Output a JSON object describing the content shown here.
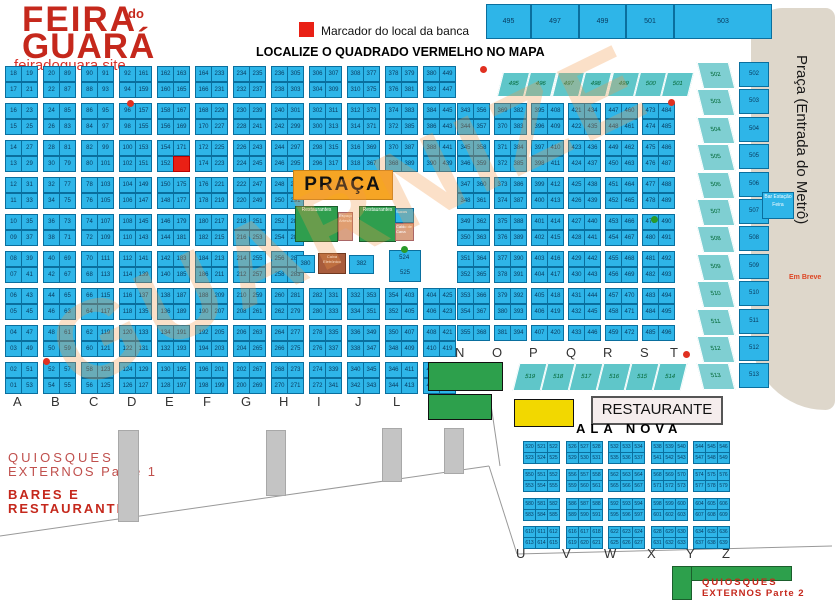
{
  "header": {
    "logo_top": "FEIRA",
    "logo_mid": "do",
    "logo_bottom": "GUARÁ",
    "site": "feiradoguara.site"
  },
  "legend": {
    "marker_label": "Marcador do local da banca",
    "locate": "LOCALIZE O QUADRADO VERMELHO NO MAPA"
  },
  "top_strip": [
    "495",
    "497",
    "499",
    "501",
    "503"
  ],
  "watermark": "GUARNIZE",
  "marker_stall": "173",
  "left_grid": {
    "letters": [
      "A",
      "B",
      "C",
      "D",
      "E",
      "F",
      "G",
      "H",
      "I",
      "J",
      "L",
      "M"
    ],
    "columns": [
      {
        "letter": "A",
        "left": [
          "18",
          "17",
          "16",
          "15",
          "14",
          "13",
          "12",
          "11",
          "10",
          "09",
          "08",
          "07",
          "06",
          "05",
          "04",
          "03",
          "02",
          "01"
        ],
        "right": [
          19,
          21,
          23,
          25,
          27,
          29,
          31,
          33,
          35,
          37,
          39,
          41,
          43,
          45,
          47,
          49,
          51,
          53
        ]
      },
      {
        "letter": "B",
        "left": [
          20,
          22,
          24,
          26,
          28,
          30,
          32,
          34,
          36,
          38,
          40,
          42,
          44,
          46,
          48,
          50,
          52,
          54
        ],
        "right": [
          89,
          87,
          85,
          83,
          81,
          79,
          77,
          75,
          73,
          71,
          69,
          67,
          65,
          63,
          61,
          59,
          57,
          55
        ]
      },
      {
        "letter": "C",
        "left": [
          90,
          88,
          86,
          84,
          82,
          80,
          78,
          76,
          74,
          72,
          70,
          68,
          66,
          64,
          62,
          60,
          58,
          56
        ],
        "right": [
          91,
          93,
          95,
          97,
          99,
          101,
          103,
          105,
          107,
          109,
          111,
          113,
          115,
          117,
          119,
          121,
          123,
          125
        ]
      },
      {
        "letter": "D",
        "left": [
          92,
          94,
          96,
          98,
          100,
          102,
          104,
          106,
          108,
          110,
          112,
          114,
          116,
          118,
          120,
          122,
          124,
          126
        ],
        "right": [
          161,
          159,
          157,
          155,
          153,
          151,
          149,
          147,
          145,
          143,
          141,
          139,
          137,
          135,
          133,
          131,
          129,
          127
        ]
      },
      {
        "letter": "E",
        "left": [
          162,
          160,
          158,
          156,
          154,
          152,
          150,
          148,
          146,
          144,
          142,
          140,
          138,
          136,
          134,
          132,
          130,
          128
        ],
        "right": [
          163,
          165,
          167,
          169,
          171,
          173,
          175,
          177,
          179,
          181,
          183,
          185,
          187,
          189,
          191,
          193,
          195,
          197
        ]
      },
      {
        "letter": "F",
        "left": [
          164,
          166,
          168,
          170,
          172,
          174,
          176,
          178,
          180,
          182,
          184,
          186,
          188,
          190,
          192,
          194,
          196,
          198
        ],
        "right": [
          233,
          231,
          229,
          227,
          225,
          223,
          221,
          219,
          217,
          215,
          213,
          211,
          209,
          207,
          205,
          203,
          201,
          199
        ]
      },
      {
        "letter": "G",
        "left": [
          234,
          232,
          230,
          228,
          226,
          224,
          222,
          220,
          218,
          216,
          214,
          212,
          210,
          208,
          206,
          204,
          202,
          200
        ],
        "right": [
          235,
          237,
          239,
          241,
          243,
          245,
          247,
          249,
          251,
          253,
          255,
          257,
          259,
          261,
          263,
          265,
          267,
          269
        ]
      },
      {
        "letter": "H",
        "left": [
          236,
          238,
          240,
          242,
          244,
          246,
          248,
          250,
          252,
          254,
          256,
          258,
          260,
          262,
          264,
          266,
          268,
          270
        ],
        "right": [
          305,
          303,
          301,
          299,
          297,
          295,
          293,
          291,
          289,
          287,
          285,
          283,
          281,
          279,
          277,
          275,
          273,
          271
        ]
      },
      {
        "letter": "I",
        "left": [
          306,
          304,
          302,
          300,
          298,
          296,
          282,
          280,
          278,
          276,
          274,
          272
        ],
        "right": [
          307,
          309,
          311,
          313,
          315,
          317,
          331,
          333,
          335,
          337,
          339,
          341
        ]
      },
      {
        "letter": "J",
        "left": [
          308,
          310,
          312,
          314,
          316,
          318,
          332,
          334,
          336,
          338,
          340,
          342
        ],
        "right": [
          377,
          375,
          373,
          371,
          369,
          367,
          353,
          351,
          349,
          347,
          345,
          343
        ]
      },
      {
        "letter": "L",
        "left": [
          378,
          376,
          374,
          372,
          370,
          368,
          354,
          352,
          350,
          348,
          346,
          344
        ],
        "right": [
          379,
          381,
          383,
          385,
          387,
          389,
          403,
          405,
          407,
          409,
          411,
          413
        ]
      },
      {
        "letter": "M",
        "left": [
          380,
          382,
          384,
          386,
          388,
          390,
          404,
          406,
          408,
          410,
          412,
          414
        ],
        "right": [
          449,
          447,
          445,
          443,
          441,
          439,
          425,
          423,
          421,
          419,
          417,
          415
        ]
      }
    ]
  },
  "right_grid": {
    "letters": [
      "N",
      "O",
      "P",
      "Q",
      "R",
      "S",
      "T"
    ],
    "columns": [
      {
        "letter": "N",
        "left": [
          343,
          344,
          345,
          346,
          347,
          348,
          349,
          350,
          351,
          352,
          353,
          354,
          355
        ],
        "right": [
          356,
          357,
          358,
          359,
          360,
          361,
          362,
          363,
          364,
          365,
          366,
          367,
          368
        ]
      },
      {
        "letter": "O",
        "left": [
          369,
          370,
          371,
          372,
          373,
          374,
          375,
          376,
          377,
          378,
          379,
          380,
          381
        ],
        "right": [
          382,
          383,
          384,
          385,
          386,
          387,
          388,
          389,
          390,
          391,
          392,
          393,
          394
        ]
      },
      {
        "letter": "P",
        "left": [
          395,
          396,
          397,
          398,
          399,
          400,
          401,
          402,
          403,
          404,
          405,
          406,
          407
        ],
        "right": [
          408,
          409,
          410,
          411,
          412,
          413,
          414,
          415,
          416,
          417,
          418,
          419,
          420
        ]
      },
      {
        "letter": "Q",
        "left": [
          421,
          422,
          423,
          424,
          425,
          426,
          427,
          428,
          429,
          430,
          431,
          432,
          433
        ],
        "right": [
          434,
          435,
          436,
          437,
          438,
          439,
          440,
          441,
          442,
          443,
          444,
          445,
          446
        ]
      },
      {
        "letter": "R",
        "left": [
          447,
          448,
          449,
          450,
          451,
          452,
          453,
          454,
          455,
          456,
          457,
          458,
          459
        ],
        "right": [
          460,
          461,
          462,
          463,
          464,
          465,
          466,
          467,
          468,
          469,
          470,
          471,
          472
        ]
      },
      {
        "letter": "S",
        "left": [
          473,
          474,
          475,
          476,
          477,
          478,
          479,
          480,
          481,
          482,
          483,
          484,
          485
        ],
        "right": [
          484,
          485,
          486,
          487,
          488,
          489,
          490,
          491,
          492,
          493,
          494,
          495,
          496
        ]
      }
    ],
    "teal_top": [
      495,
      496,
      497,
      498,
      499,
      500,
      501
    ],
    "teal_bottom": [
      519,
      518,
      517,
      516,
      515,
      514
    ]
  },
  "metro": {
    "label": "Praça (Entrada do Metrô)",
    "em_breve": "Em Breve",
    "bar": "Bar Estação Feira",
    "stalls": [
      502,
      503,
      504,
      505,
      506,
      507,
      508,
      509,
      510,
      511,
      512,
      513
    ]
  },
  "cluster": {
    "praca": "PRAÇA",
    "green1": "Restaurantes",
    "tan1": "Espaço Artesão",
    "green2": "Restaurantes",
    "cyan_small": "Sucos",
    "tan2": "Caldo de Cana",
    "cyan_a": "380",
    "brown": "Caixa Eletrônico",
    "cyan_b": "382",
    "tall": [
      "524",
      "525"
    ]
  },
  "ala_nova": {
    "title": "ALA NOVA",
    "letters": [
      "U",
      "V",
      "W",
      "X",
      "Y",
      "Z"
    ],
    "block_bases": [
      [
        520,
        526,
        532,
        538,
        544
      ],
      [
        550,
        556,
        562,
        568,
        574
      ],
      [
        580,
        586,
        592,
        598,
        604
      ],
      [
        610,
        616,
        622,
        628,
        634
      ]
    ]
  },
  "south": {
    "q1a": "QUIOSQUES",
    "q1b": "EXTERNOS Parte 1",
    "bares_a": "BARES E",
    "bares_b": "RESTAURANTES",
    "restaurante": "RESTAURANTE",
    "q2a": "QUIOSQUES",
    "q2b": "EXTERNOS Parte 2"
  }
}
